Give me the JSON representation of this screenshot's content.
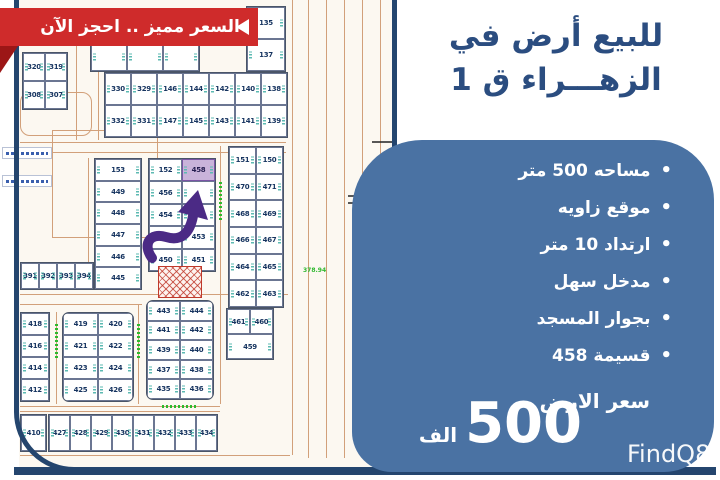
{
  "ribbon": {
    "text": "السعر مميز .. احجز الآن"
  },
  "title": {
    "line1": "للبيع أرض في",
    "line2": "الزهـــراء ق 1"
  },
  "panel": {
    "bullets": [
      "مساحه 500 متر",
      "موقع زاويه",
      "ارتداد 10 متر",
      "مدخل سهل",
      "بجوار المسجد",
      "قسيمة 458"
    ],
    "price_label": "سعر الارض",
    "price_value": "500",
    "price_unit": "الف"
  },
  "watermark": "FindQ8",
  "colors": {
    "panel_blue": "#4a72a3",
    "title_navy": "#2b4d80",
    "frame_navy": "#24456e",
    "ribbon_red": "#cf2b2b",
    "ribbon_fold_red": "#9c1616",
    "arrow_purple": "#4b2a85",
    "highlight_plot_fill": "#c9b3da",
    "road_tan": "#d2a07a",
    "street_label_green": "#2eb82e"
  },
  "map": {
    "highlight_plot": "458",
    "road_label": "378.94",
    "blocks": [
      {
        "id": "320",
        "x": 22,
        "y": 52,
        "w": 46,
        "h": 58,
        "rows": [
          [
            "320",
            "319"
          ],
          [
            "308",
            "307"
          ]
        ]
      },
      {
        "id": "toprow",
        "x": 90,
        "y": 42,
        "w": 110,
        "h": 30,
        "rows": [
          [
            "",
            "",
            ""
          ]
        ]
      },
      {
        "id": "135",
        "x": 246,
        "y": 6,
        "w": 40,
        "h": 66,
        "rows": [
          [
            "135"
          ],
          [
            "137"
          ]
        ]
      },
      {
        "id": "topgrid",
        "x": 104,
        "y": 72,
        "w": 184,
        "h": 66,
        "rows": [
          [
            "330",
            "329",
            "146",
            "144",
            "142",
            "140",
            "138"
          ],
          [
            "332",
            "331",
            "147",
            "145",
            "143",
            "141",
            "139"
          ]
        ]
      },
      {
        "id": "153col",
        "x": 94,
        "y": 158,
        "w": 48,
        "h": 132,
        "rows": [
          [
            "153"
          ],
          [
            "449"
          ],
          [
            "448"
          ],
          [
            "447"
          ],
          [
            "446"
          ],
          [
            "445"
          ]
        ]
      },
      {
        "id": "458block",
        "x": 148,
        "y": 158,
        "w": 68,
        "h": 114,
        "rows": [
          [
            "152",
            "458"
          ],
          [
            "456",
            ""
          ],
          [
            "454",
            "455"
          ],
          [
            "452",
            "453"
          ],
          [
            "450",
            "451"
          ]
        ]
      },
      {
        "id": "470col",
        "x": 228,
        "y": 146,
        "w": 56,
        "h": 162,
        "rows": [
          [
            "151",
            "150"
          ],
          [
            "470",
            "471"
          ],
          [
            "468",
            "469"
          ],
          [
            "466",
            "467"
          ],
          [
            "464",
            "465"
          ],
          [
            "462",
            "463"
          ]
        ]
      },
      {
        "id": "459block",
        "x": 226,
        "y": 308,
        "w": 48,
        "h": 52,
        "rows": [
          [
            "461",
            "460"
          ],
          [
            "459"
          ]
        ]
      },
      {
        "id": "391row",
        "x": 20,
        "y": 262,
        "w": 74,
        "h": 28,
        "rows": [
          [
            "391",
            "392",
            "393",
            "394"
          ]
        ]
      },
      {
        "id": "418col",
        "x": 20,
        "y": 312,
        "w": 30,
        "h": 90,
        "rows": [
          [
            "418"
          ],
          [
            "416"
          ],
          [
            "414"
          ],
          [
            "412"
          ]
        ]
      },
      {
        "id": "419block",
        "x": 62,
        "y": 312,
        "w": 72,
        "h": 90,
        "r": 1,
        "rows": [
          [
            "419",
            "420"
          ],
          [
            "421",
            "422"
          ],
          [
            "423",
            "424"
          ],
          [
            "425",
            "426"
          ]
        ]
      },
      {
        "id": "443block",
        "x": 146,
        "y": 300,
        "w": 68,
        "h": 100,
        "r": 1,
        "rows": [
          [
            "443",
            "444"
          ],
          [
            "441",
            "442"
          ],
          [
            "439",
            "440"
          ],
          [
            "437",
            "438"
          ],
          [
            "435",
            "436"
          ]
        ]
      },
      {
        "id": "bottomrow",
        "x": 48,
        "y": 414,
        "w": 170,
        "h": 38,
        "rows": [
          [
            "427",
            "428",
            "429",
            "430",
            "431",
            "432",
            "433",
            "434"
          ]
        ]
      },
      {
        "id": "410",
        "x": 20,
        "y": 414,
        "w": 27,
        "h": 38,
        "rows": [
          [
            "410"
          ]
        ]
      }
    ]
  }
}
